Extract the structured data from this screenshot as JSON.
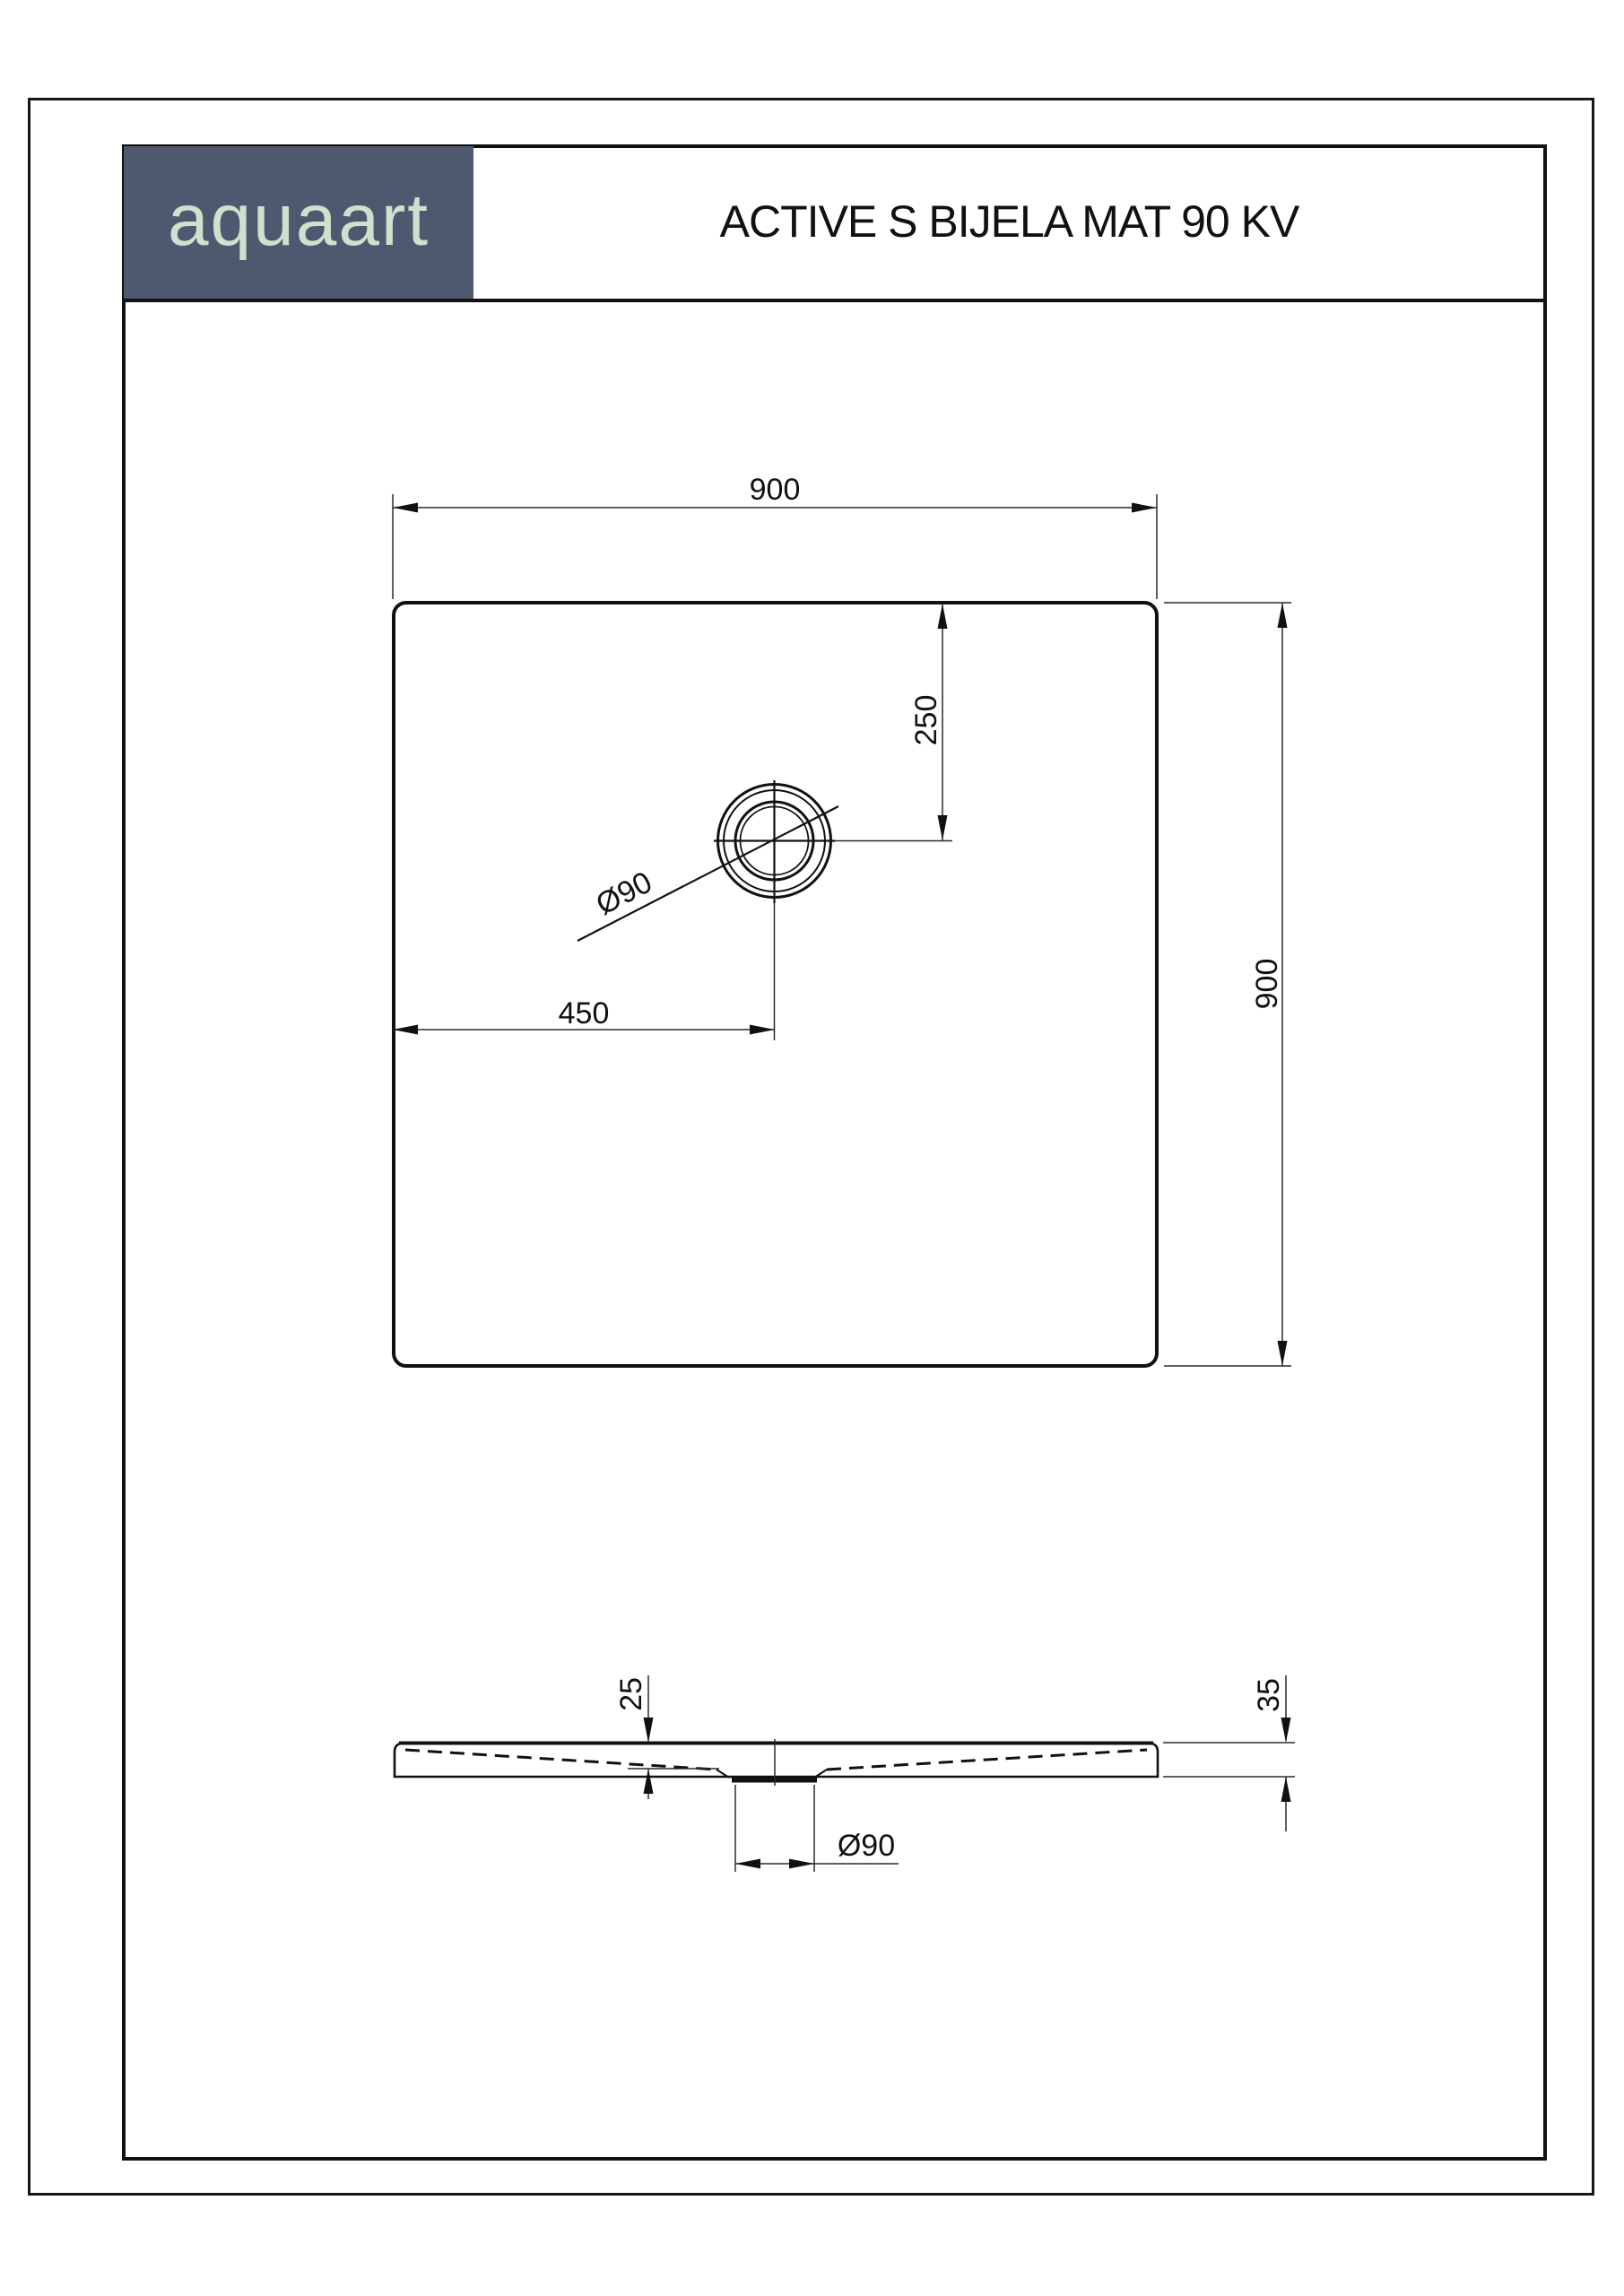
{
  "header": {
    "brand": "aquaart",
    "title": "ACTIVE S BIJELA MAT 90 KV"
  },
  "colors": {
    "brand_bg": "#4e586e",
    "brand_text": "#d0e0ce",
    "ink": "#111111",
    "paper": "#ffffff"
  },
  "top_view": {
    "view_name": "plan-view",
    "width": "900",
    "height": "900",
    "drain_offset_from_top": "250",
    "drain_offset_from_left": "450",
    "drain_diameter": "Ø90"
  },
  "side_view": {
    "view_name": "section-view",
    "basin_depth": "25",
    "edge_height": "35",
    "drain_diameter": "Ø90"
  }
}
